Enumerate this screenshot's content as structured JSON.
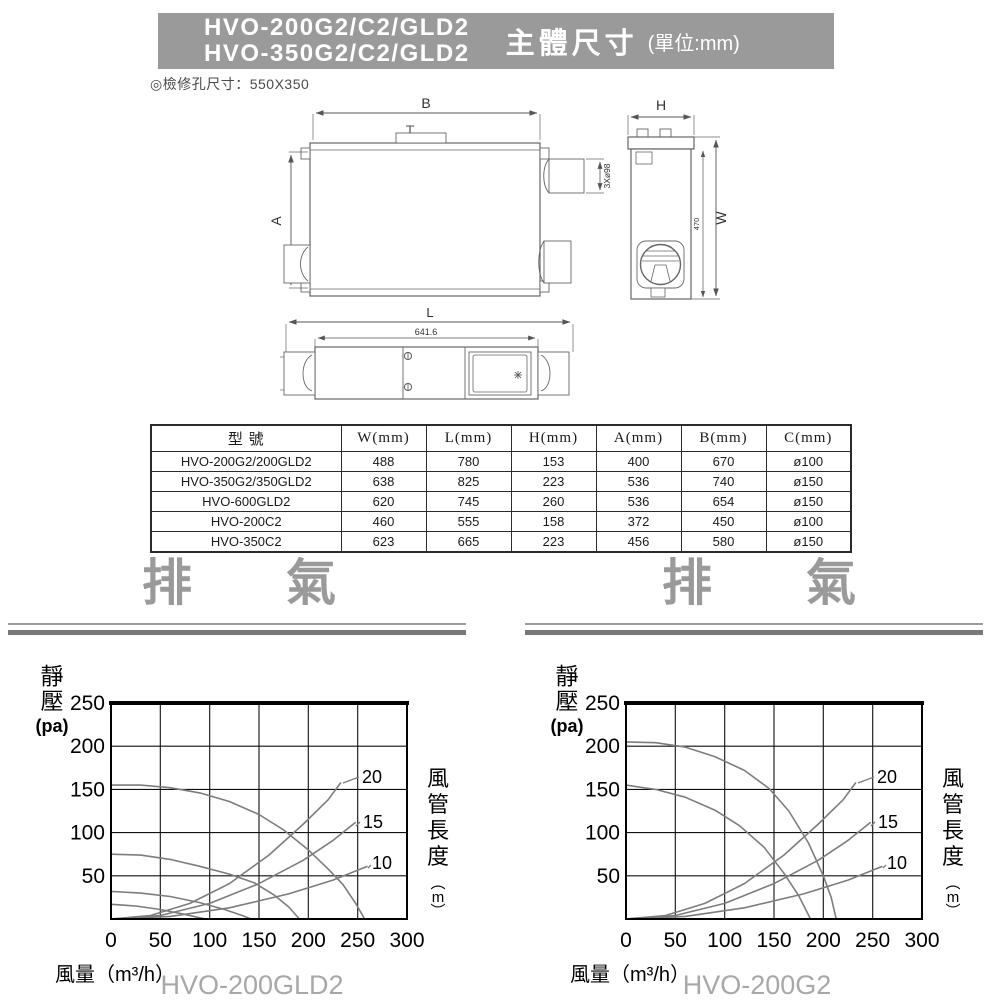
{
  "header": {
    "models": [
      "HVO-200G2/C2/GLD2",
      "HVO-350G2/C2/GLD2"
    ],
    "title": "主體尺寸",
    "unit": "(單位:mm)",
    "banner_color": "#9a9a9a"
  },
  "note": "◎檢修孔尺寸：550X350",
  "drawing": {
    "dim_b": "B",
    "dim_a": "A",
    "dim_h": "H",
    "dim_w": "W",
    "dim_w_inner": "470",
    "dim_l": "L",
    "dim_l_inner": "641.6",
    "duct_note": "3Xø98"
  },
  "table": {
    "headers": [
      "型 號",
      "W(mm)",
      "L(mm)",
      "H(mm)",
      "A(mm)",
      "B(mm)",
      "C(mm)"
    ],
    "rows": [
      [
        "HVO-200G2/200GLD2",
        "488",
        "780",
        "153",
        "400",
        "670",
        "ø100"
      ],
      [
        "HVO-350G2/350GLD2",
        "638",
        "825",
        "223",
        "536",
        "740",
        "ø150"
      ],
      [
        "HVO-600GLD2",
        "620",
        "745",
        "260",
        "536",
        "654",
        "ø150"
      ],
      [
        "HVO-200C2",
        "460",
        "555",
        "158",
        "372",
        "450",
        "ø100"
      ],
      [
        "HVO-350C2",
        "623",
        "665",
        "223",
        "456",
        "580",
        "ø150"
      ]
    ]
  },
  "sections": {
    "left_heading": "排　氣",
    "right_heading": "排　氣",
    "heading_color": "#9a9a9a"
  },
  "chart_data": [
    {
      "type": "line",
      "title": "HVO-200GLD2",
      "xlabel": "風量（m³/h）",
      "ylabel_chars": [
        "靜",
        "壓"
      ],
      "ylabel_unit": "(pa)",
      "right_label_chars": [
        "風",
        "管",
        "長",
        "度"
      ],
      "right_unit_chars": [
        "︵",
        "m",
        "︶"
      ],
      "xlim": [
        0,
        300
      ],
      "ylim": [
        0,
        250
      ],
      "xticks": [
        "0",
        "50",
        "100",
        "150",
        "200",
        "250",
        "300"
      ],
      "yticks": [
        "250",
        "200",
        "150",
        "100",
        "50"
      ],
      "grid": true,
      "curve_color": "#7d7d7d",
      "curve_labels": [
        "20",
        "15",
        "10"
      ],
      "fan_series": [
        {
          "name": "fan-speed-4",
          "points": [
            [
              0,
              155
            ],
            [
              30,
              155
            ],
            [
              60,
              152
            ],
            [
              90,
              146
            ],
            [
              120,
              136
            ],
            [
              150,
              121
            ],
            [
              175,
              103
            ],
            [
              200,
              80
            ],
            [
              220,
              58
            ],
            [
              235,
              40
            ],
            [
              248,
              18
            ],
            [
              257,
              0
            ]
          ]
        },
        {
          "name": "fan-speed-3",
          "points": [
            [
              0,
              75
            ],
            [
              30,
              74
            ],
            [
              60,
              69
            ],
            [
              90,
              61
            ],
            [
              120,
              52
            ],
            [
              145,
              42
            ],
            [
              165,
              28
            ],
            [
              180,
              14
            ],
            [
              191,
              0
            ]
          ]
        },
        {
          "name": "fan-speed-2",
          "points": [
            [
              0,
              32
            ],
            [
              30,
              30
            ],
            [
              60,
              26
            ],
            [
              90,
              19
            ],
            [
              115,
              11
            ],
            [
              133,
              4
            ],
            [
              142,
              0
            ]
          ]
        },
        {
          "name": "fan-speed-1",
          "points": [
            [
              0,
              17
            ],
            [
              25,
              15
            ],
            [
              50,
              11
            ],
            [
              72,
              6
            ],
            [
              88,
              2
            ],
            [
              96,
              0
            ]
          ]
        }
      ],
      "duct_series": [
        {
          "name": "duct-20m",
          "label": "20",
          "points": [
            [
              0,
              0
            ],
            [
              40,
              4
            ],
            [
              80,
              18
            ],
            [
              120,
              41
            ],
            [
              160,
              74
            ],
            [
              195,
              110
            ],
            [
              220,
              138
            ],
            [
              233,
              158
            ]
          ]
        },
        {
          "name": "duct-15m",
          "label": "15",
          "points": [
            [
              0,
              0
            ],
            [
              50,
              4
            ],
            [
              100,
              18
            ],
            [
              150,
              41
            ],
            [
              195,
              68
            ],
            [
              225,
              91
            ],
            [
              248,
              112
            ]
          ]
        },
        {
          "name": "duct-10m",
          "label": "10",
          "points": [
            [
              0,
              0
            ],
            [
              60,
              3
            ],
            [
              120,
              13
            ],
            [
              180,
              29
            ],
            [
              225,
              45
            ],
            [
              260,
              61
            ]
          ]
        }
      ]
    },
    {
      "type": "line",
      "title": "HVO-200G2",
      "xlabel": "風量（m³/h）",
      "ylabel_chars": [
        "靜",
        "壓"
      ],
      "ylabel_unit": "(pa)",
      "right_label_chars": [
        "風",
        "管",
        "長",
        "度"
      ],
      "right_unit_chars": [
        "︵",
        "m",
        "︶"
      ],
      "xlim": [
        0,
        300
      ],
      "ylim": [
        0,
        250
      ],
      "xticks": [
        "0",
        "50",
        "100",
        "150",
        "200",
        "250",
        "300"
      ],
      "yticks": [
        "250",
        "200",
        "150",
        "100",
        "50"
      ],
      "grid": true,
      "curve_color": "#7d7d7d",
      "curve_labels": [
        "20",
        "15",
        "10"
      ],
      "fan_series": [
        {
          "name": "fan-speed-2",
          "points": [
            [
              0,
              205
            ],
            [
              30,
              204
            ],
            [
              60,
              199
            ],
            [
              90,
              188
            ],
            [
              120,
              172
            ],
            [
              145,
              151
            ],
            [
              165,
              125
            ],
            [
              185,
              88
            ],
            [
              200,
              50
            ],
            [
              208,
              25
            ],
            [
              213,
              0
            ]
          ]
        },
        {
          "name": "fan-speed-1",
          "points": [
            [
              0,
              155
            ],
            [
              30,
              150
            ],
            [
              60,
              141
            ],
            [
              90,
              126
            ],
            [
              115,
              108
            ],
            [
              140,
              83
            ],
            [
              160,
              53
            ],
            [
              175,
              27
            ],
            [
              187,
              0
            ]
          ]
        }
      ],
      "duct_series": [
        {
          "name": "duct-20m",
          "label": "20",
          "points": [
            [
              0,
              0
            ],
            [
              40,
              4
            ],
            [
              80,
              18
            ],
            [
              120,
              41
            ],
            [
              160,
              74
            ],
            [
              195,
              110
            ],
            [
              220,
              138
            ],
            [
              233,
              158
            ]
          ]
        },
        {
          "name": "duct-15m",
          "label": "15",
          "points": [
            [
              0,
              0
            ],
            [
              50,
              4
            ],
            [
              100,
              18
            ],
            [
              150,
              41
            ],
            [
              195,
              68
            ],
            [
              225,
              91
            ],
            [
              248,
              112
            ]
          ]
        },
        {
          "name": "duct-10m",
          "label": "10",
          "points": [
            [
              0,
              0
            ],
            [
              60,
              3
            ],
            [
              120,
              13
            ],
            [
              180,
              29
            ],
            [
              225,
              45
            ],
            [
              260,
              61
            ]
          ]
        }
      ]
    }
  ]
}
